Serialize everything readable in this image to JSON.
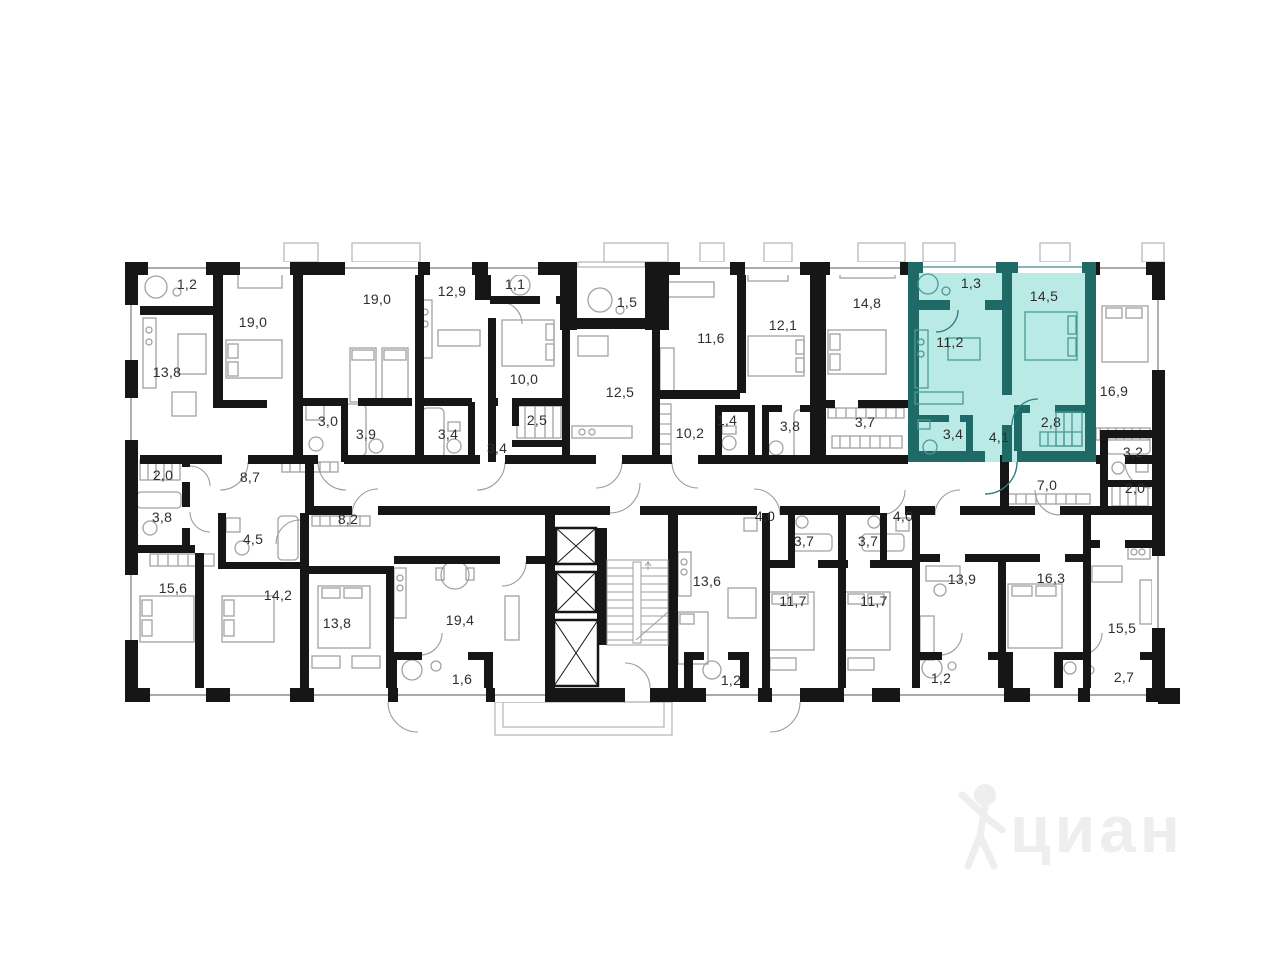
{
  "areas": [
    "1,2",
    "19,0",
    "19,0",
    "12,9",
    "1,1",
    "13,8",
    "10,0",
    "1,5",
    "12,5",
    "11,6",
    "12,1",
    "14,8",
    "1,3",
    "14,5",
    "11,2",
    "16,9",
    "3,0",
    "3,9",
    "3,4",
    "3,4",
    "2,5",
    "10,2",
    "1,4",
    "3,8",
    "3,7",
    "3,4",
    "4,1",
    "2,8",
    "3,2",
    "2,0",
    "8,7",
    "7,0",
    "2,0",
    "3,8",
    "4,5",
    "8,2",
    "15,6",
    "14,2",
    "13,8",
    "19,4",
    "4,0",
    "3,7",
    "3,7",
    "13,6",
    "11,7",
    "11,7",
    "4,0",
    "13,9",
    "16,3",
    "15,5",
    "1,6",
    "1,2",
    "1,2",
    "2,7"
  ],
  "selected_apartment": {
    "room_areas": [
      "1,3",
      "14,5",
      "11,2",
      "3,4",
      "4,1",
      "2,8"
    ],
    "fill_color": "#b9eae6",
    "wall_color": "#1f6a66"
  },
  "colors": {
    "wall": "#161616",
    "furniture_line": "#a2a2a2",
    "label_text": "#2e2e2e"
  },
  "watermark": {
    "text": "циан",
    "color": "#eeeeee"
  }
}
